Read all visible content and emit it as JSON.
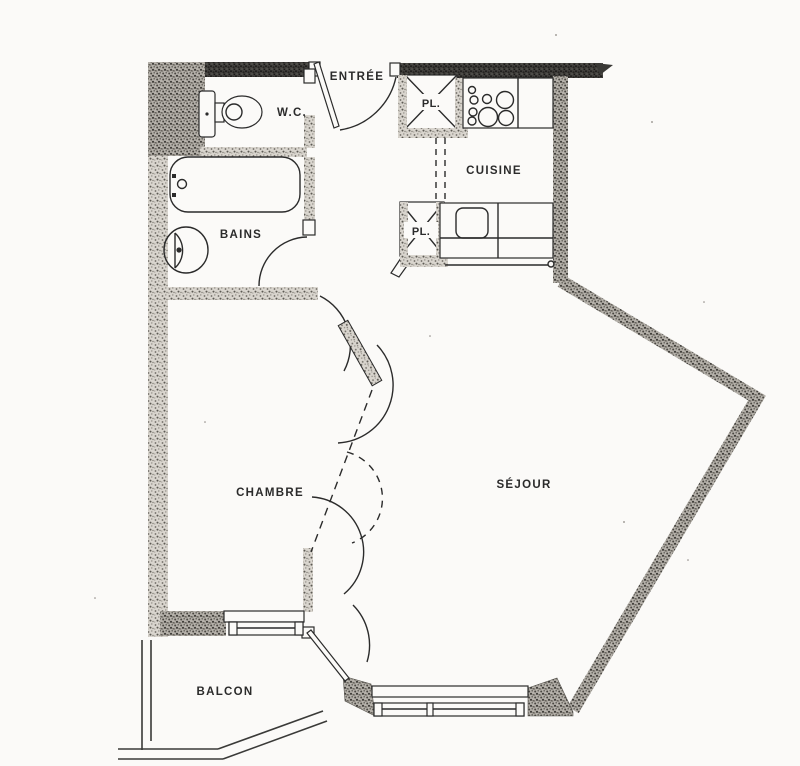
{
  "plan": {
    "title": "apartment-floor-plan",
    "labels": {
      "entree": "ENTRÉE",
      "wc": "W.C.",
      "pl_top": "PL.",
      "cuisine": "CUISINE",
      "pl_bottom": "PL.",
      "bains": "BAINS",
      "chambre": "CHAMBRE",
      "sejour": "SÉJOUR",
      "balcon": "BALCON"
    },
    "colors": {
      "paper": "#fbfaf8",
      "ink": "#2b2b2b",
      "wall_light": "#d9d5ce",
      "wall_medium": "#b5b1aa",
      "wall_dark": "#413f3c"
    }
  }
}
